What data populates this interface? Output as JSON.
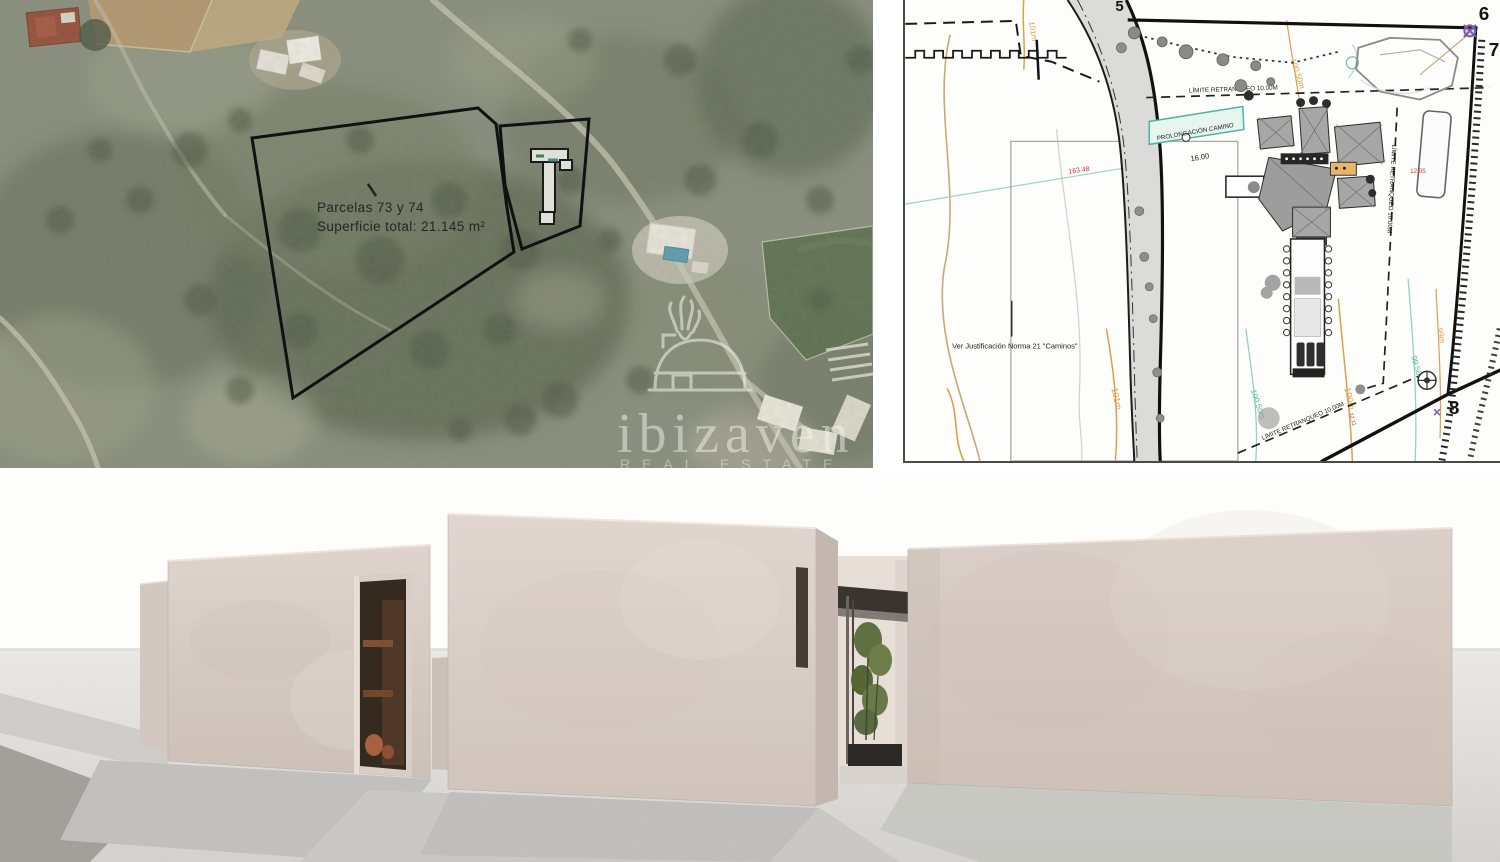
{
  "satellite": {
    "annotation_line1": "Parcelas 73 y 74",
    "annotation_line2": "Superficie total: 21.145 m²",
    "watermark_brand": "ibizaven",
    "watermark_tagline": "REAL ESTATE"
  },
  "site_plan": {
    "road_label": "PROLONGACIÓN CAMINO",
    "road_width_dim": "16.00",
    "setback_top": "LÍMITE RETRANQUEO 10.00M",
    "setback_side": "LÍMITE RETRANQUEO 10.00M",
    "setback_bottom": "LÍMITE RETRANQUEO 10.00M",
    "note_caminos": "Ver Justificación Norma 21 \"Caminos\"",
    "level_red": "163.48",
    "pool_dim": "12.05",
    "slope_dim": "12.11",
    "contours": {
      "c101_top": "101m",
      "c101_bot": "101m",
      "c100_50_top": "100.50m",
      "c100_50": "100.50m",
      "c100": "100m",
      "c99_50": "99.50m",
      "c99": "99m"
    },
    "corners": {
      "n5": "5",
      "n6": "6",
      "n7": "7",
      "n8": "8"
    }
  },
  "colors": {
    "contour_orange": "#dd9f4a",
    "contour_teal": "#63c0b2",
    "dimension_red": "#cc3333",
    "survey_purple": "#7b5ea7",
    "parcel_outline": "#111111"
  }
}
